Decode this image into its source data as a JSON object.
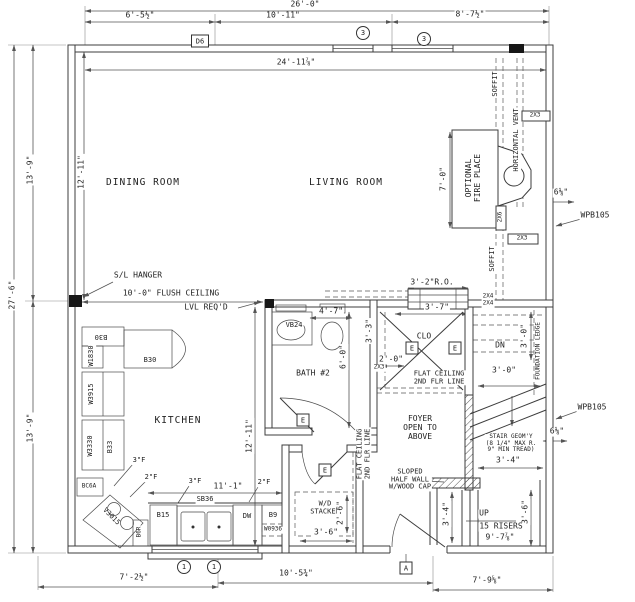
{
  "drawing": {
    "kind": "architectural first-floor plan",
    "line_color": "#3c3c3c",
    "background": "#ffffff"
  },
  "rooms": {
    "dining": "DINING ROOM",
    "living": "LIVING ROOM",
    "kitchen": "KITCHEN",
    "bath2": "BATH #2",
    "foyer": "FOYER\nOPEN TO\nABOVE",
    "closet": "CLO",
    "washer_dryer": "W/D\nSTACKED"
  },
  "dims": {
    "top_overall": "26'-0\"",
    "top_seg_left": "6'-5½\"",
    "top_seg_mid": "10'-11\"",
    "top_seg_right": "8'-7½\"",
    "top_interior": "24'-11⅞\"",
    "left_overall": "27'-6\"",
    "left_upper": "13'-9\"",
    "left_lower": "13'-9\"",
    "dining_interior": "12'-11\"",
    "kitchen_interior": "12'-11\"",
    "bottom_seg_left": "7'-2½\"",
    "bottom_seg_mid": "10'-5¾\"",
    "bottom_seg_right": "7'-9⅝\"",
    "fireplace_width": "7'-0\"",
    "vent_offset_upper": "6⅛\"",
    "vent_offset_lower": "6⅛\"",
    "stair_window_ro": "3'-2\"R.O.",
    "closet_opening": "3'-7\"",
    "closet_depth": "2'-0\"",
    "bath_fixture": "4'-7\"",
    "bath_interior": "6'-0\"",
    "bath_closet_side": "3'-3\"",
    "ledge_vertical": "3'-0\"",
    "ledge_horizontal": "3'-0\"",
    "counter_run": "11'-1\"",
    "stair_landing": "3'-4\"",
    "stair_flight_width": "3'-4\"",
    "stair_bottom_width": "3'-6\"",
    "wd_width": "3'-6\"",
    "wd_depth": "2'-6\"",
    "stair_total_run": "9'-7⅞\"",
    "flush_ceiling": "10'-0\" FLUSH CEILING",
    "lvl_reqd": "LVL REQ'D"
  },
  "annotations": {
    "sl_hanger": "S/L HANGER",
    "soffit_upper": "SOFFIT",
    "soffit_lower": "SOFFIT",
    "horizontal_vent": "HORIZONTAL VENT",
    "optional_fireplace": "OPTIONAL\nFIRE PLACE",
    "wpb105_upper": "WPB105",
    "wpb105_lower": "WPB105",
    "flat_ceiling_foyer": "FLAT CEILING\n2ND FLR LINE",
    "flat_ceiling_hall": "FLAT CEILING\n2ND FLR LINE",
    "down": "DN",
    "up": "UP",
    "risers": "15 RISERS",
    "stair_geometry": "STAIR GEOM'Y\n(8 1/4\" MAX R.\n9\" MIN TREAD)",
    "sloped_half_wall": "SLOPED\nHALF WALL\nW/WOOD CAP",
    "foundation_ledge": "FOUNDATION LEDGE",
    "framing_2x3_top": "2X3",
    "framing_2x3_bottom": "2X3",
    "framing_2x3_closet": "2X3",
    "framing_2x6": "2X6",
    "framing_2x4_a": "2X4",
    "framing_2x4_b": "2X4",
    "filler_3f_a": "3\"F",
    "filler_2f_a": "2\"F",
    "filler_3f_b": "3\"F",
    "filler_2f_b": "2\"F"
  },
  "cabinets": {
    "b30_upper": "B30",
    "w1830": "W1830",
    "b30_peninsula": "B30",
    "w3915": "W3915",
    "w3330": "W3330",
    "b33": "B33",
    "bc6a": "BC6A",
    "v3015": "V3015",
    "b6r": "B6R",
    "b15": "B15",
    "sb36": "SB36",
    "dw": "DW",
    "b9": "B9",
    "w0936": "W0936",
    "vb24": "VB24"
  },
  "markers": {
    "door_tag": "D6",
    "window_tag": "3",
    "sill_tag": "1",
    "section_tag": "A",
    "electrical": "E"
  }
}
